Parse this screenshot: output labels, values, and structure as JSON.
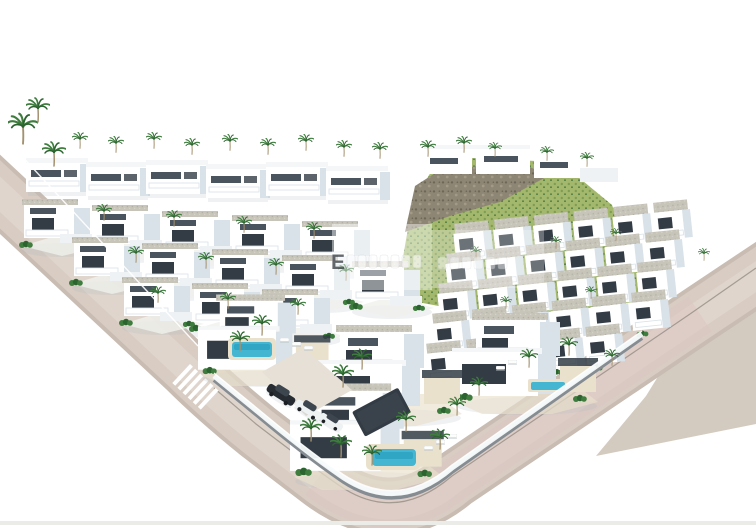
{
  "scene": {
    "kind": "aerial-3d-render-residential-development",
    "watermark": {
      "letter": "E"
    }
  },
  "palette": {
    "bg": "#ffffff",
    "road-base": "#c9bcb2",
    "road-main": "#d8ccc3",
    "road-light": "#e6dcd3",
    "road-pink": "#dcc6c3",
    "pavement": "#d3cbbf",
    "curb": "#8a847c",
    "wall-white": "#ffffff",
    "wall-shade": "#eef2f5",
    "wall-shade2": "#d9e2e8",
    "opening": "#333c45",
    "opening-soft": "#4a545e",
    "roof-light": "#f4f6f7",
    "roof-gravel": "#c7c4ba",
    "gravel-d1": "#b2afa4",
    "gravel-d2": "#dad7cd",
    "hill-light": "#a3b86c",
    "hill-dark": "#71924a",
    "rock": "#8e8674",
    "rock-dark": "#665f50",
    "palm": "#3e7d3e",
    "palm-dark": "#2c642f",
    "trunk": "#a3916f",
    "pool": "#45b6d1",
    "pool-deep": "#1e95b7",
    "deck": "#eae1cd",
    "fence": "#f7fbfc",
    "wallbase": "#858c92",
    "shadow": "#aeb9c0",
    "car-dark": "#272c32",
    "car-white": "#eff2f3",
    "ground": "#f0f1ec",
    "drive": "#e6e0d6",
    "edge-strip": "#ebebe7"
  }
}
